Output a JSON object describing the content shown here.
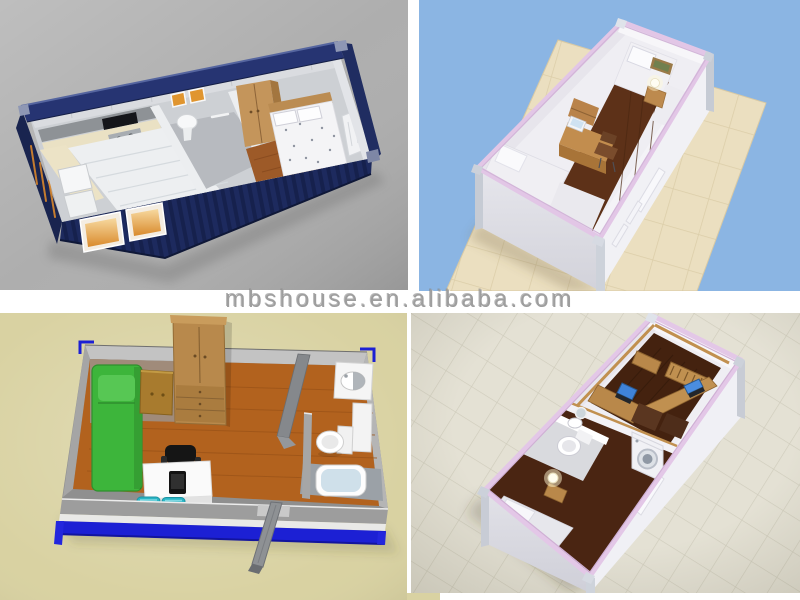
{
  "image": {
    "type": "product-photo-collage",
    "grid": "2x2",
    "subject": "prefab shipping container house 3D interior renders"
  },
  "watermark": {
    "text": "mbshouse.en.alibaba.com",
    "color": "#9e9e9e",
    "band_color": "#ffffff"
  },
  "tiles": {
    "top_left": {
      "label": "3D render: dark blue shipping container house, open top showing kitchen, bathroom, wardrobe and bedroom",
      "background": "#aeaeae",
      "accent": "#1d2a5e"
    },
    "top_right": {
      "label": "3D render: white container room with lilac trim, two beds, desk and chair on tiled floor",
      "background": "#8bb5e3",
      "accent": "#e2c6e6"
    },
    "bottom_left": {
      "label": "3D floor plan: container home with green bed, nightstand, wardrobe, desk with office chair and bathroom",
      "background": "#d9d2a2",
      "accent": "#1c20d4"
    },
    "bottom_right": {
      "label": "3D render: white container with lilac trim, office with two desks, bathroom, washing machine and bed",
      "background": "#e4e1d4",
      "accent": "#e3c7e7"
    }
  },
  "palette": {
    "container_navy": "#1d2a5e",
    "lilac_trim": "#e2c6e6",
    "wood_floor_plan": "#b2621e",
    "dark_wood_floor": "#5d3118",
    "green_bed": "#3db53b",
    "cyan_stools": "#29b5c5",
    "frame_blue": "#1c20d4",
    "tile_floor_warm": "#ebdfc0",
    "tile_floor_cool": "#e4e1d4",
    "desk_wood": "#b9884a",
    "laptop_screen_blue": "#3f83d9"
  }
}
